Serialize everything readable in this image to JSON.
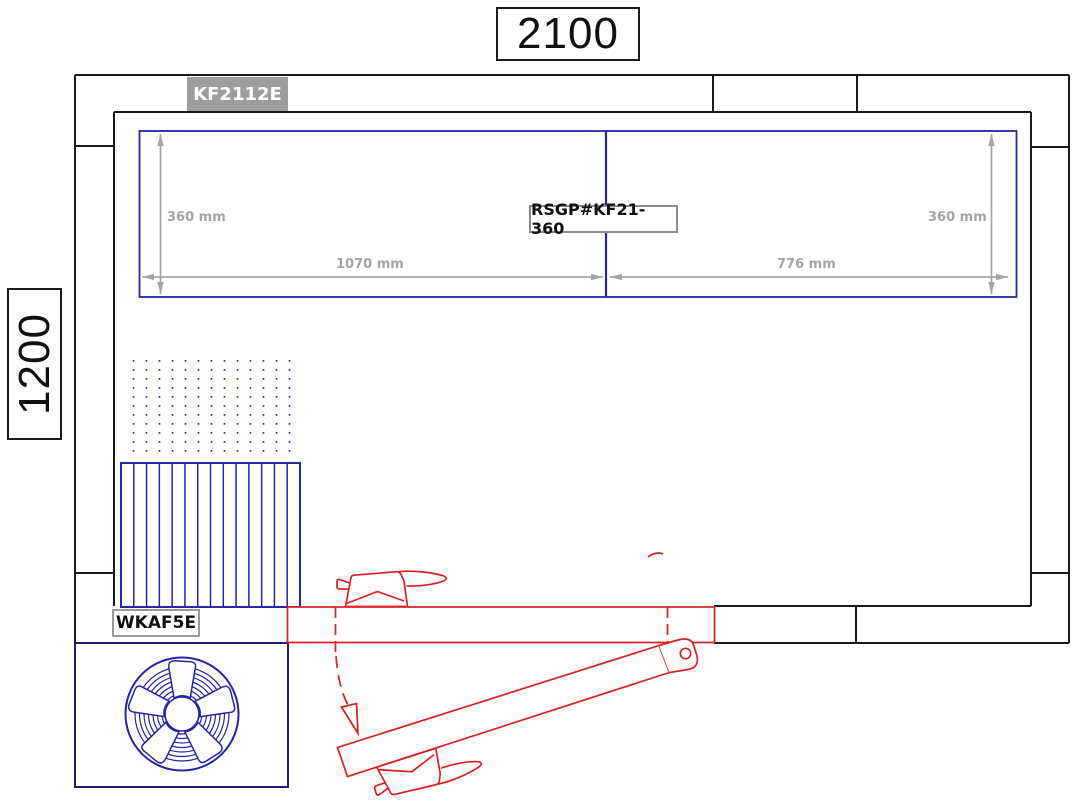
{
  "drawing": {
    "overall_width": "2100",
    "overall_depth": "1200",
    "wall_panel_code": "KF2112E",
    "ceiling_panel_code": "RSGP#KF21-360",
    "evaporator_code": "WKAF5E",
    "dim_left_height": "360 mm",
    "dim_right_height": "360 mm",
    "dim_span_left": "1070 mm",
    "dim_span_right": "776 mm"
  },
  "colors": {
    "line_black": "#1a1a1a",
    "line_blue": "#2525ad",
    "line_red": "#e02020",
    "dim_gray": "#a4a4a8",
    "label_gray_bg": "#9d9d9d",
    "label_border": "#8c8c8c",
    "fan_box": "#20206e"
  }
}
